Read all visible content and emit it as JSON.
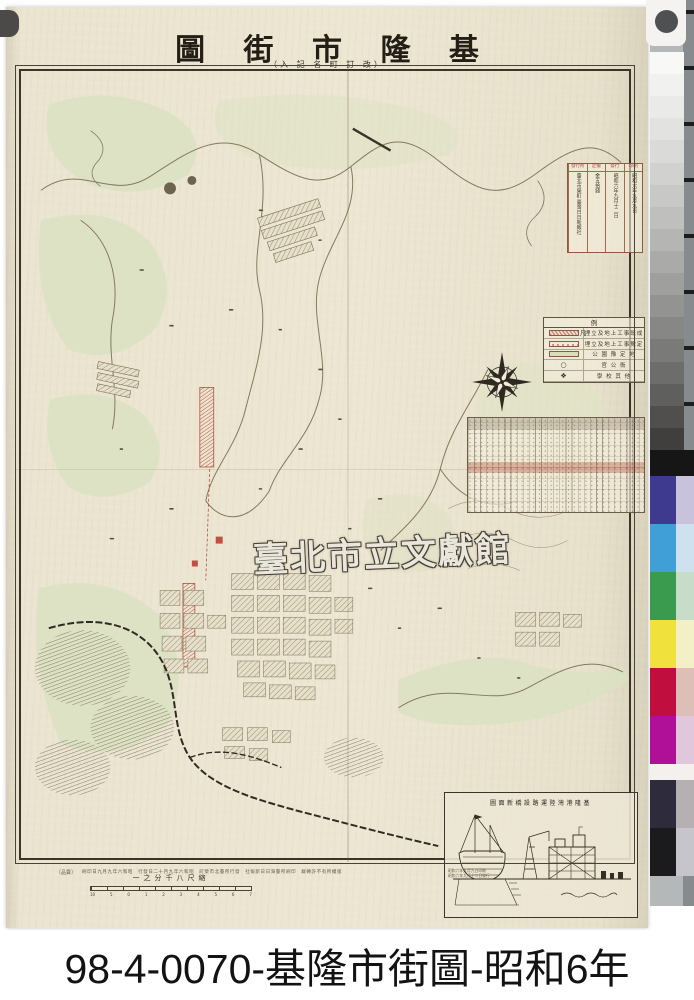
{
  "caption": {
    "text": "98-4-0070-基隆市街圖-昭和6年"
  },
  "sheet": {
    "title_display": "圖 街 市 隆 基",
    "subtitle_display": "（入 記 名 町 訂 改）",
    "watermark_text": "臺北市立文獻館"
  },
  "colophon": {
    "cells": [
      {
        "header": "印刷",
        "value": "昭和六年九月九日"
      },
      {
        "header": "發行",
        "value": "昭和六年九月十二日"
      },
      {
        "header": "定價",
        "value": "金五拾錢"
      },
      {
        "header": "發行所",
        "value": "臺北市榮町 臺灣日日新報社"
      }
    ]
  },
  "legend": {
    "title_display": "例　凡",
    "rows": [
      {
        "type": "hatch-red",
        "symbol": "",
        "label": "埋立及地上工事既成"
      },
      {
        "type": "dots-pink",
        "symbol": "",
        "label": "埋立及地上工事豫定"
      },
      {
        "type": "fill-green",
        "symbol": "",
        "label": "公 園 豫 定 地"
      },
      {
        "type": "sym",
        "symbol": "○",
        "label": "官 公 衙"
      },
      {
        "type": "sym",
        "symbol": "❖",
        "label": "學 校 其 他"
      }
    ]
  },
  "scale_bar": {
    "label_display": "一之分千八尺縮",
    "ticks": [
      "10",
      "5",
      "0",
      "1",
      "2",
      "3",
      "4",
      "5",
      "6",
      "7"
    ]
  },
  "inset": {
    "title_display": "圖面新橋設路運陸灣港隆基"
  },
  "imprint": {
    "left_display": "〔品賣〕",
    "line_display": "刷印日九月九年六和昭　行發日二十月九年六和昭　町榮市北臺所行發　社報新日日灣臺所刷印　載轉許不有所權版",
    "right_lines": [
      "昭和六年九月九日印刷",
      "昭和六年九月十二日發行"
    ]
  },
  "calibration": {
    "gray_steps": [
      "#f8f8f6",
      "#f1f1ef",
      "#eaeae8",
      "#e2e2e0",
      "#dadad8",
      "#d1d1cf",
      "#c8c8c6",
      "#bfbfbd",
      "#b5b5b3",
      "#aaaaa8",
      "#9f9f9d",
      "#939391",
      "#878785",
      "#7a7a78",
      "#6d6d6b",
      "#5f5f5d",
      "#504f4d",
      "#413f3e"
    ],
    "separator_color": "#161616",
    "color_rows": [
      {
        "main": "#3d3a8f",
        "tint": "#c9c2dd",
        "h": "48"
      },
      {
        "main": "#3f9fd6",
        "tint": "#cfe1ef",
        "h": "48"
      },
      {
        "main": "#3a9a4e",
        "tint": "#c7ddc9",
        "h": "48"
      },
      {
        "main": "#f0e13d",
        "tint": "#f3efc7",
        "h": "48"
      },
      {
        "main": "#c00f3e",
        "tint": "#ddbfb7",
        "h": "48"
      },
      {
        "main": "#b01098",
        "tint": "#e1c7db",
        "h": "48"
      },
      {
        "main": "#f3f0ed",
        "tint": "#f3f0ed",
        "h": "16"
      },
      {
        "main": "#2e2c3c",
        "tint": "#b7b0b2",
        "h": "48"
      },
      {
        "main": "#1b1b1d",
        "tint": "#c5c5cb",
        "h": "48"
      }
    ]
  }
}
